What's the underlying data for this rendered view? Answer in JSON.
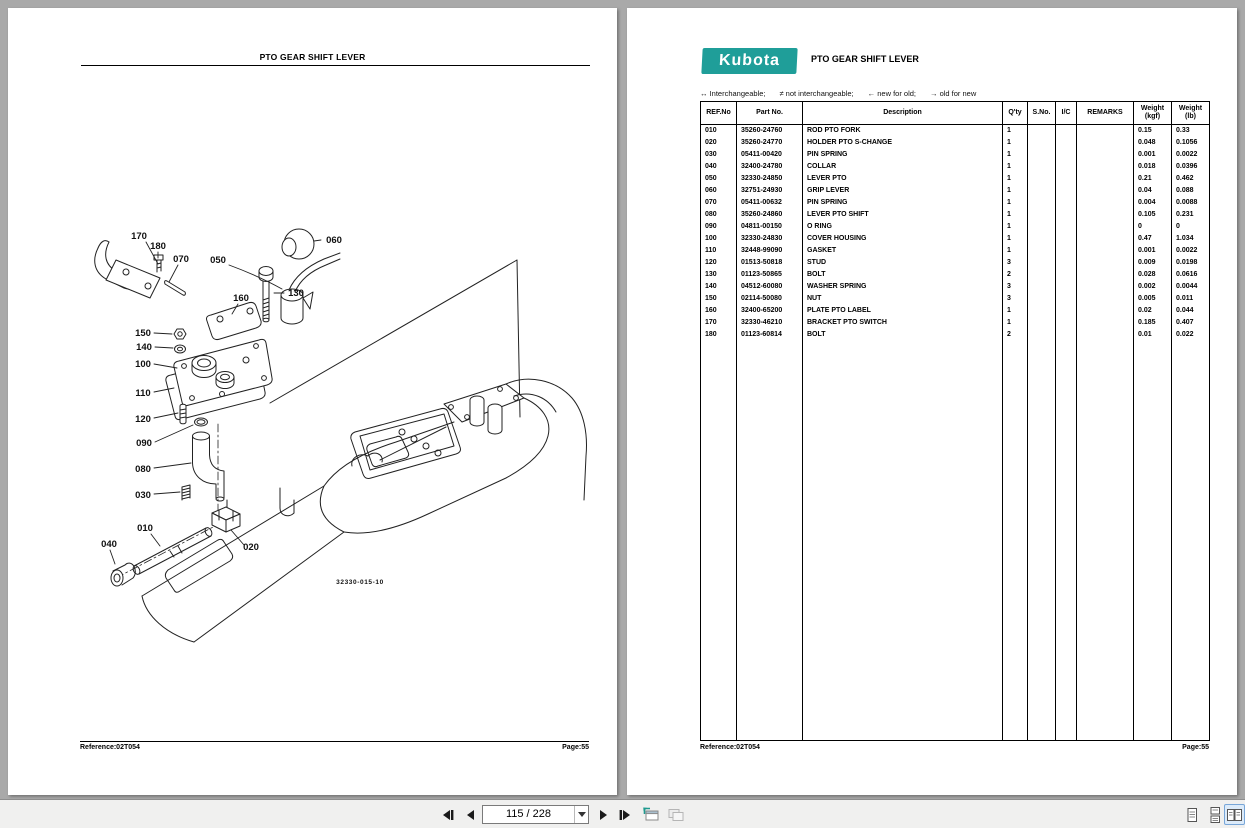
{
  "colors": {
    "kubota_teal": "#1f9e99",
    "canvas_background": "#a9a9a9",
    "toolbar_background": "#f0f0ef",
    "selected_view_bg": "#dcebfa",
    "selected_view_border": "#78a6d8"
  },
  "toolbar": {
    "page_indicator": "115 / 228",
    "icons": [
      "first-page",
      "previous-page",
      "page-number-combo",
      "next-page",
      "last-page",
      "previous-view",
      "next-view",
      "single-page-view",
      "continuous-view",
      "two-page-view"
    ]
  },
  "left_page": {
    "title": "PTO GEAR SHIFT LEVER",
    "drawing_number": "32330-015-10",
    "footer": {
      "reference": "Reference:02T054",
      "page": "Page:55"
    },
    "diagram": {
      "callouts": [
        {
          "label": "170",
          "x": 131,
          "y": 231
        },
        {
          "label": "180",
          "x": 150,
          "y": 241
        },
        {
          "label": "070",
          "x": 173,
          "y": 254
        },
        {
          "label": "050",
          "x": 210,
          "y": 255
        },
        {
          "label": "060",
          "x": 326,
          "y": 235
        },
        {
          "label": "130",
          "x": 288,
          "y": 288
        },
        {
          "label": "160",
          "x": 233,
          "y": 293
        },
        {
          "label": "150",
          "x": 135,
          "y": 328
        },
        {
          "label": "140",
          "x": 136,
          "y": 342
        },
        {
          "label": "100",
          "x": 135,
          "y": 359
        },
        {
          "label": "110",
          "x": 135,
          "y": 388
        },
        {
          "label": "120",
          "x": 135,
          "y": 414
        },
        {
          "label": "090",
          "x": 136,
          "y": 438
        },
        {
          "label": "080",
          "x": 135,
          "y": 464
        },
        {
          "label": "030",
          "x": 135,
          "y": 490
        },
        {
          "label": "010",
          "x": 137,
          "y": 523
        },
        {
          "label": "040",
          "x": 101,
          "y": 539
        },
        {
          "label": "020",
          "x": 243,
          "y": 542
        }
      ]
    }
  },
  "right_page": {
    "logo_text": "Kubota",
    "title": "PTO GEAR SHIFT LEVER",
    "legend_items": [
      "↔ Interchangeable;",
      "≠ not interchangeable;",
      "← new for old;",
      "→ old for new"
    ],
    "table": {
      "headers": [
        "REF.No",
        "Part No.",
        "Description",
        "Q'ty",
        "S.No.",
        "I/C",
        "REMARKS",
        "Weight\n(kgf)",
        "Weight\n(lb)"
      ],
      "rows": [
        [
          "010",
          "35260-24760",
          "ROD PTO FORK",
          "1",
          "",
          "",
          "",
          "0.15",
          "0.33"
        ],
        [
          "020",
          "35260-24770",
          "HOLDER PTO S-CHANGE",
          "1",
          "",
          "",
          "",
          "0.048",
          "0.1056"
        ],
        [
          "030",
          "05411-00420",
          "PIN SPRING",
          "1",
          "",
          "",
          "",
          "0.001",
          "0.0022"
        ],
        [
          "040",
          "32400-24780",
          "COLLAR",
          "1",
          "",
          "",
          "",
          "0.018",
          "0.0396"
        ],
        [
          "050",
          "32330-24850",
          "LEVER PTO",
          "1",
          "",
          "",
          "",
          "0.21",
          "0.462"
        ],
        [
          "060",
          "32751-24930",
          "GRIP LEVER",
          "1",
          "",
          "",
          "",
          "0.04",
          "0.088"
        ],
        [
          "070",
          "05411-00632",
          "PIN SPRING",
          "1",
          "",
          "",
          "",
          "0.004",
          "0.0088"
        ],
        [
          "080",
          "35260-24860",
          "LEVER PTO SHIFT",
          "1",
          "",
          "",
          "",
          "0.105",
          "0.231"
        ],
        [
          "090",
          "04811-00150",
          "O RING",
          "1",
          "",
          "",
          "",
          "0",
          "0"
        ],
        [
          "100",
          "32330-24830",
          "COVER HOUSING",
          "1",
          "",
          "",
          "",
          "0.47",
          "1.034"
        ],
        [
          "110",
          "32448-99090",
          "GASKET",
          "1",
          "",
          "",
          "",
          "0.001",
          "0.0022"
        ],
        [
          "120",
          "01513-50818",
          "STUD",
          "3",
          "",
          "",
          "",
          "0.009",
          "0.0198"
        ],
        [
          "130",
          "01123-50865",
          "BOLT",
          "2",
          "",
          "",
          "",
          "0.028",
          "0.0616"
        ],
        [
          "140",
          "04512-60080",
          "WASHER SPRING",
          "3",
          "",
          "",
          "",
          "0.002",
          "0.0044"
        ],
        [
          "150",
          "02114-50080",
          "NUT",
          "3",
          "",
          "",
          "",
          "0.005",
          "0.011"
        ],
        [
          "160",
          "32400-65200",
          "PLATE PTO LABEL",
          "1",
          "",
          "",
          "",
          "0.02",
          "0.044"
        ],
        [
          "170",
          "32330-46210",
          "BRACKET PTO SWITCH",
          "1",
          "",
          "",
          "",
          "0.185",
          "0.407"
        ],
        [
          "180",
          "01123-60814",
          "BOLT",
          "2",
          "",
          "",
          "",
          "0.01",
          "0.022"
        ]
      ]
    },
    "footer": {
      "reference": "Reference:02T054",
      "page": "Page:55"
    }
  }
}
